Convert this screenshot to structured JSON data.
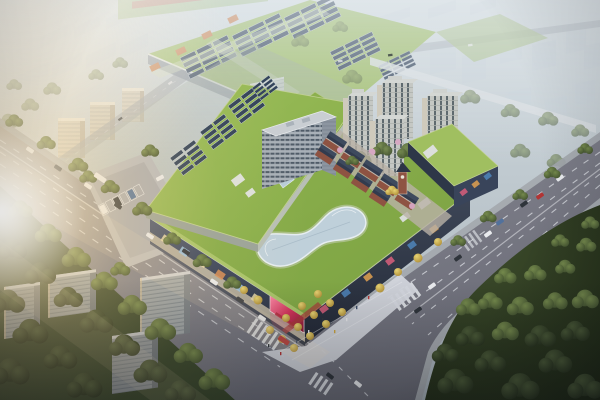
{
  "image": {
    "type": "aerial-architectural-rendering",
    "description": "Bird's-eye dusk rendering of a mixed-use commercial complex: a green-roofed shopping mall with a curved glass rooftop skylight and solar arrays, a mid-rise office slab, four residential towers, a European-style retail street, an LED-billboard entrance plaza and surface parking, framed by two wide tree-lined avenues meeting at an intersection, a dense forest park at lower right, large green-roofed industrial halls and hazy apartment blocks in the background, with warm sun flare from the left."
  },
  "scene": {
    "residential_tower_count": 4,
    "landmarks": [
      "shopping-mall-podium",
      "rooftop-skylight",
      "solar-roof-arrays",
      "office-slab",
      "residential-towers",
      "european-retail-street",
      "east-retail-podium",
      "entrance-plaza",
      "led-billboard",
      "parking-lot",
      "main-avenue",
      "east-boulevard",
      "intersection",
      "industrial-halls",
      "forest-park",
      "city-haze",
      "sun-flare"
    ]
  },
  "palette": {
    "road": "#84848e",
    "road_line": "#dde0e6",
    "sidewalk": "#a3a7ad",
    "mall_roof_green": "#8db14e",
    "mall_roof_green_light": "#a0bf60",
    "industrial_roof": "#9dbb66",
    "industrial_accent": "#c97f4f",
    "solar_panel": "#32435a",
    "mall_facade_dark": "#333e50",
    "skylight_glass": "#bfd0da",
    "euro_brick": "#8e5342",
    "euro_roof": "#323b4e",
    "plaza": "#d2d5dc",
    "tree_autumn": "#d9c35a",
    "forest": "#33402a",
    "led_screen": "#d94f6e",
    "car_white": "#e9ebee",
    "car_dark": "#2f343b",
    "car_red": "#b23434"
  }
}
